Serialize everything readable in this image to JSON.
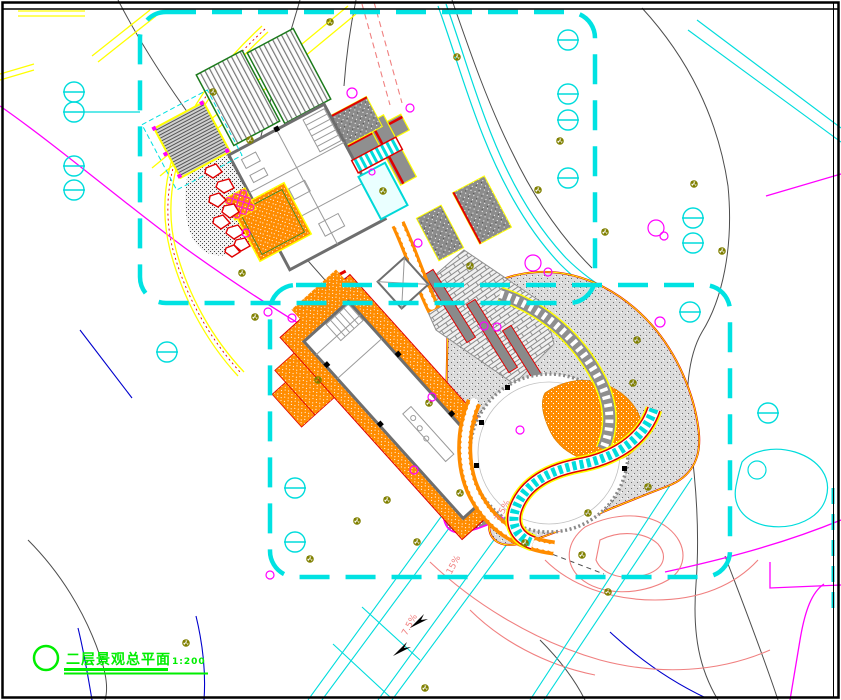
{
  "drawing": {
    "title": "二层景观总平面",
    "scale": "1:200",
    "slope_labels": [
      "7.5%",
      "15%",
      "7.5%"
    ],
    "colors": {
      "boundary_cyan": "#00e2e2",
      "road_yellow": "#ffff00",
      "paving_orange": "#ff8c00",
      "water_cyan": "#00dcdc",
      "vegetation_olive": "#808000",
      "shrub_magenta": "#ff00ff",
      "contour_gray": "#4d4d4d",
      "contour_magenta": "#ff00ff",
      "contour_salmon": "#f08080",
      "contour_blue": "#0000cd",
      "accent_red": "#e00000",
      "wall_gray": "#6e6e6e",
      "title_green": "#00ee00"
    }
  }
}
